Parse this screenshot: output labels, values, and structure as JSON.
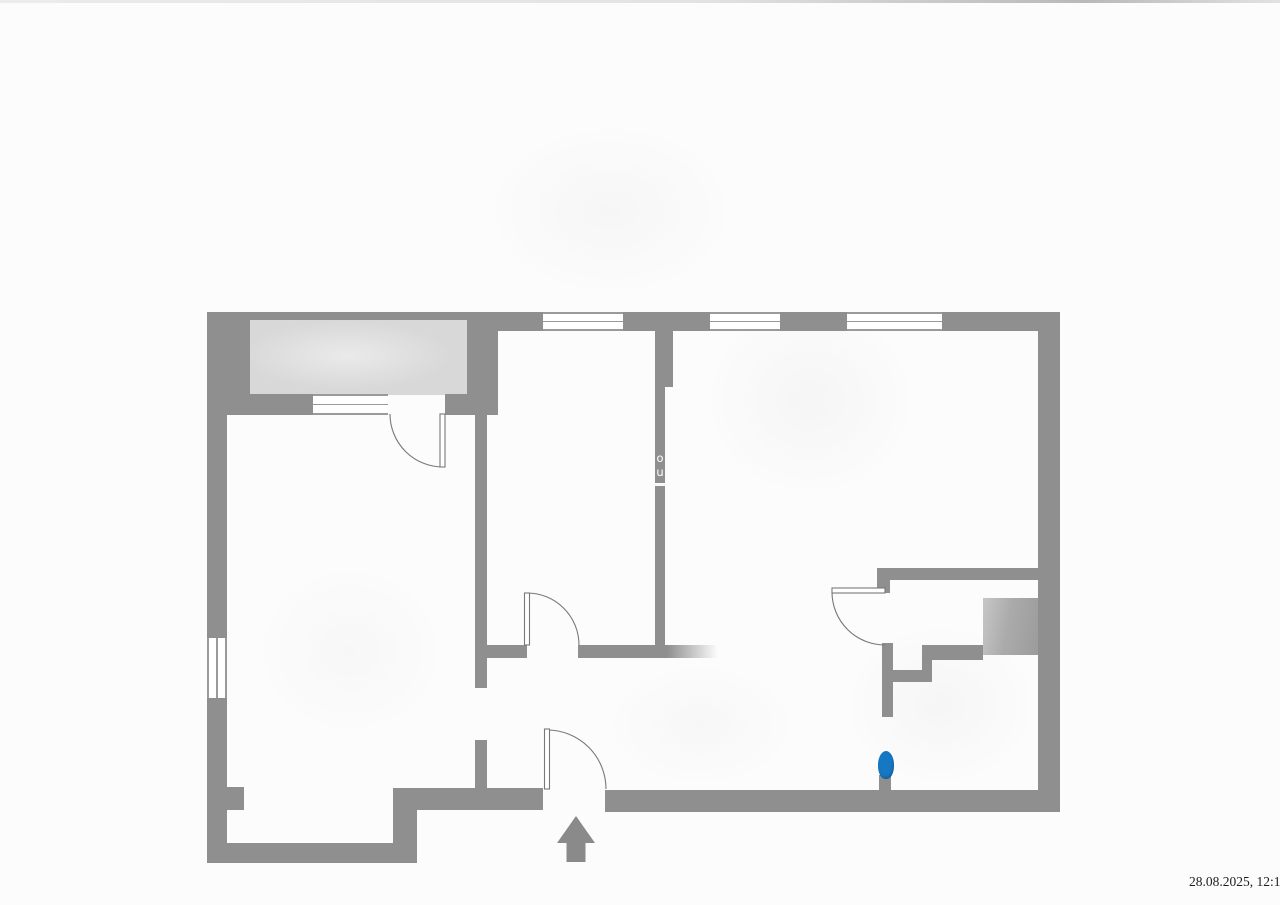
{
  "scan": {
    "timestamp": "28.08.2025, 12:18"
  },
  "plan": {
    "watermark_top": "o",
    "watermark_bottom": "u",
    "colors": {
      "wall": "#8f8f8f",
      "balcony": "#d8d8d8",
      "shaft_gradient_light": "#c7c7c7",
      "shaft_gradient_dark": "#9b9b9b",
      "window_line": "#9a9a9a",
      "door_line": "#787878",
      "entrance_arrow": "#8a8a8a",
      "marker_blue": "#1677c3",
      "page_background": "#fcfcfc"
    },
    "icons": {
      "entrance_arrow": "up-arrow-icon",
      "marker": "location-dot-icon"
    }
  }
}
